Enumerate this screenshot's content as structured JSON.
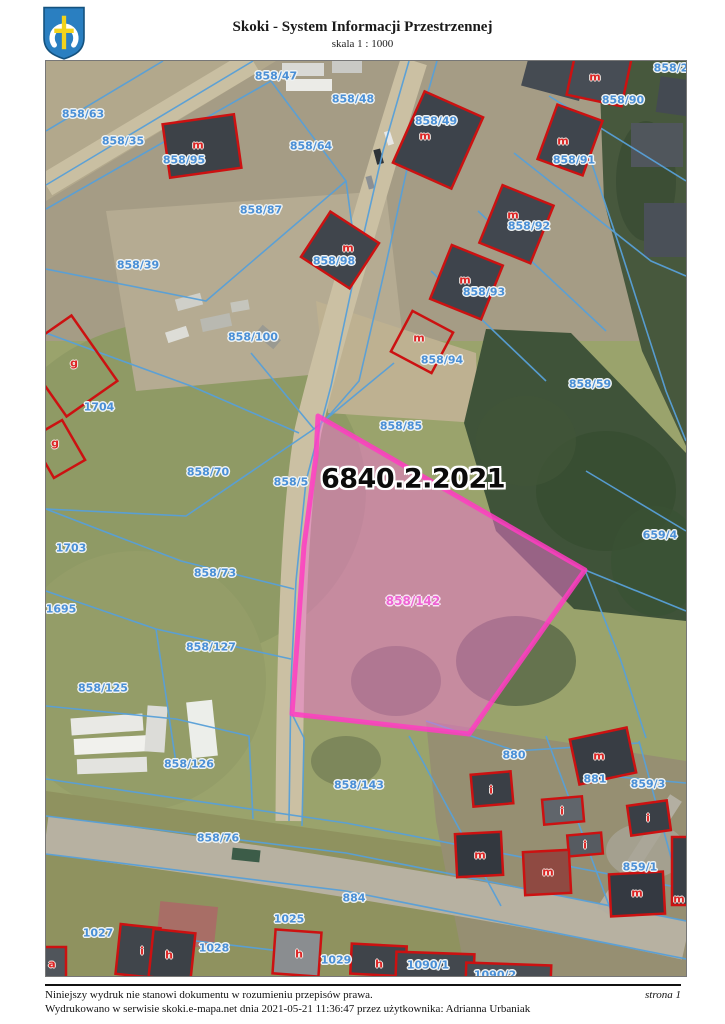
{
  "header": {
    "title": "Skoki - System Informacji Przestrzennej",
    "scale": "skala 1 : 1000",
    "logo": "skoki-coat-of-arms"
  },
  "map": {
    "highlight_title": "6840.2.2021",
    "highlight_parcel": "858/142",
    "colors": {
      "parcel_line": "#58a0d8",
      "building_outline": "#cc1111",
      "highlight_stroke": "#ff3cc2",
      "highlight_fill": "#f274d2",
      "parcel_label": "#4a8fd6",
      "building_letter": "#dd2525",
      "highlight_label": "#ee62d2"
    },
    "labels": [
      {
        "text": "858/47",
        "x": 230,
        "y": 15,
        "type": "parcel"
      },
      {
        "text": "858/48",
        "x": 307,
        "y": 38,
        "type": "parcel"
      },
      {
        "text": "858/2",
        "x": 625,
        "y": 7,
        "type": "parcel"
      },
      {
        "text": "858/63",
        "x": 37,
        "y": 53,
        "type": "parcel"
      },
      {
        "text": "858/35",
        "x": 77,
        "y": 80,
        "type": "parcel"
      },
      {
        "text": "858/64",
        "x": 265,
        "y": 85,
        "type": "parcel"
      },
      {
        "text": "858/90",
        "x": 577,
        "y": 39,
        "type": "parcel"
      },
      {
        "text": "858/49",
        "x": 390,
        "y": 60,
        "type": "parcel"
      },
      {
        "text": "858/95",
        "x": 138,
        "y": 99,
        "type": "parcel"
      },
      {
        "text": "858/91",
        "x": 528,
        "y": 99,
        "type": "parcel"
      },
      {
        "text": "858/87",
        "x": 215,
        "y": 149,
        "type": "parcel"
      },
      {
        "text": "858/92",
        "x": 483,
        "y": 165,
        "type": "parcel"
      },
      {
        "text": "858/98",
        "x": 288,
        "y": 200,
        "type": "parcel"
      },
      {
        "text": "858/39",
        "x": 92,
        "y": 204,
        "type": "parcel"
      },
      {
        "text": "858/93",
        "x": 438,
        "y": 231,
        "type": "parcel"
      },
      {
        "text": "858/100",
        "x": 207,
        "y": 276,
        "type": "parcel"
      },
      {
        "text": "858/94",
        "x": 396,
        "y": 299,
        "type": "parcel"
      },
      {
        "text": "858/59",
        "x": 544,
        "y": 323,
        "type": "parcel"
      },
      {
        "text": "1704",
        "x": 53,
        "y": 346,
        "type": "parcel"
      },
      {
        "text": "858/85",
        "x": 355,
        "y": 365,
        "type": "parcel"
      },
      {
        "text": "858/70",
        "x": 162,
        "y": 411,
        "type": "parcel"
      },
      {
        "text": "858/5",
        "x": 245,
        "y": 421,
        "type": "parcel"
      },
      {
        "text": "659/4",
        "x": 614,
        "y": 474,
        "type": "parcel"
      },
      {
        "text": "1703",
        "x": 25,
        "y": 487,
        "type": "parcel"
      },
      {
        "text": "858/73",
        "x": 169,
        "y": 512,
        "type": "parcel"
      },
      {
        "text": "1695",
        "x": 15,
        "y": 548,
        "type": "parcel"
      },
      {
        "text": "858/127",
        "x": 165,
        "y": 586,
        "type": "parcel"
      },
      {
        "text": "858/125",
        "x": 57,
        "y": 627,
        "type": "parcel"
      },
      {
        "text": "858/126",
        "x": 143,
        "y": 703,
        "type": "parcel"
      },
      {
        "text": "858/143",
        "x": 313,
        "y": 724,
        "type": "parcel"
      },
      {
        "text": "880",
        "x": 468,
        "y": 694,
        "type": "parcel"
      },
      {
        "text": "881",
        "x": 549,
        "y": 718,
        "type": "parcel"
      },
      {
        "text": "859/3",
        "x": 602,
        "y": 723,
        "type": "parcel"
      },
      {
        "text": "858/76",
        "x": 172,
        "y": 777,
        "type": "parcel"
      },
      {
        "text": "859/1",
        "x": 594,
        "y": 806,
        "type": "parcel"
      },
      {
        "text": "884",
        "x": 308,
        "y": 837,
        "type": "parcel"
      },
      {
        "text": "1025",
        "x": 243,
        "y": 858,
        "type": "parcel"
      },
      {
        "text": "1027",
        "x": 52,
        "y": 872,
        "type": "parcel"
      },
      {
        "text": "1028",
        "x": 168,
        "y": 887,
        "type": "parcel"
      },
      {
        "text": "1029",
        "x": 290,
        "y": 899,
        "type": "parcel"
      },
      {
        "text": "1090/1",
        "x": 382,
        "y": 904,
        "type": "parcel"
      },
      {
        "text": "1090/2",
        "x": 449,
        "y": 914,
        "type": "parcel"
      },
      {
        "text": "858/142",
        "x": 367,
        "y": 540,
        "type": "highlight"
      },
      {
        "text": "6840.2.2021",
        "x": 367,
        "y": 418,
        "type": "title"
      },
      {
        "text": "m",
        "x": 152,
        "y": 84,
        "type": "letter"
      },
      {
        "text": "m",
        "x": 549,
        "y": 16,
        "type": "letter"
      },
      {
        "text": "m",
        "x": 379,
        "y": 75,
        "type": "letter"
      },
      {
        "text": "m",
        "x": 517,
        "y": 80,
        "type": "letter"
      },
      {
        "text": "m",
        "x": 467,
        "y": 154,
        "type": "letter"
      },
      {
        "text": "m",
        "x": 302,
        "y": 187,
        "type": "letter"
      },
      {
        "text": "m",
        "x": 419,
        "y": 219,
        "type": "letter"
      },
      {
        "text": "m",
        "x": 373,
        "y": 277,
        "type": "letter"
      },
      {
        "text": "g",
        "x": 28,
        "y": 302,
        "type": "letter"
      },
      {
        "text": "g",
        "x": 9,
        "y": 382,
        "type": "letter"
      },
      {
        "text": "m",
        "x": 553,
        "y": 695,
        "type": "letter"
      },
      {
        "text": "i",
        "x": 445,
        "y": 729,
        "type": "letter"
      },
      {
        "text": "i",
        "x": 516,
        "y": 750,
        "type": "letter"
      },
      {
        "text": "i",
        "x": 602,
        "y": 757,
        "type": "letter"
      },
      {
        "text": "i",
        "x": 539,
        "y": 784,
        "type": "letter"
      },
      {
        "text": "m",
        "x": 434,
        "y": 794,
        "type": "letter"
      },
      {
        "text": "m",
        "x": 502,
        "y": 811,
        "type": "letter"
      },
      {
        "text": "m",
        "x": 591,
        "y": 832,
        "type": "letter"
      },
      {
        "text": "m",
        "x": 633,
        "y": 838,
        "type": "letter"
      },
      {
        "text": "i",
        "x": 96,
        "y": 890,
        "type": "letter"
      },
      {
        "text": "h",
        "x": 123,
        "y": 894,
        "type": "letter"
      },
      {
        "text": "h",
        "x": 253,
        "y": 893,
        "type": "letter"
      },
      {
        "text": "h",
        "x": 333,
        "y": 903,
        "type": "letter"
      },
      {
        "text": "a",
        "x": 6,
        "y": 903,
        "type": "letter"
      }
    ]
  },
  "footer": {
    "disclaimer": "Niniejszy wydruk nie stanowi dokumentu w rozumieniu przepisów prawa.",
    "printed": "Wydrukowano w serwisie skoki.e-mapa.net dnia 2021-05-21 11:36:47 przez użytkownika: Adrianna Urbaniak",
    "page": "strona 1"
  }
}
